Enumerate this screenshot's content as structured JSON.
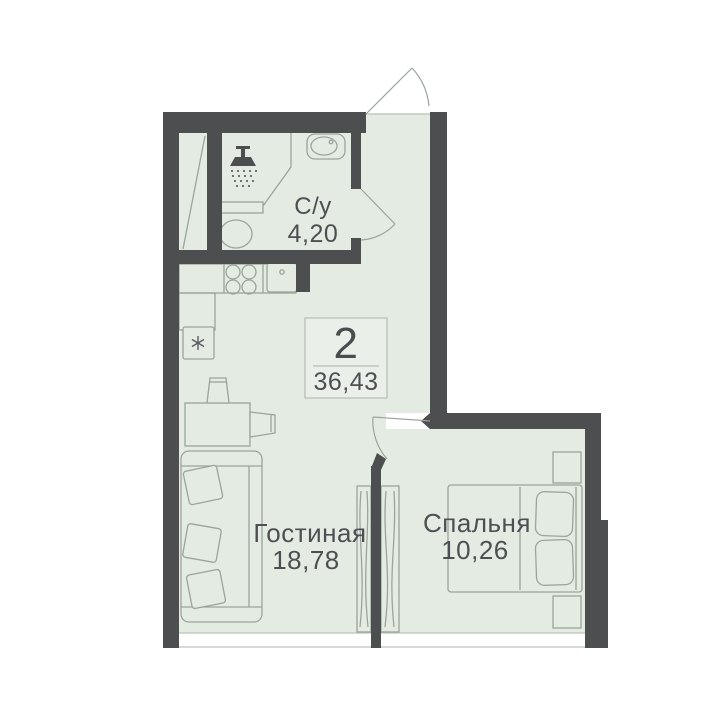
{
  "plan": {
    "summary": {
      "rooms_count": "2",
      "total_area": "36,43"
    },
    "rooms": [
      {
        "name": "bathroom",
        "label": "С/у",
        "area": "4,20"
      },
      {
        "name": "living-room",
        "label": "Гостиная",
        "area": "18,78"
      },
      {
        "name": "bedroom",
        "label": "Спальня",
        "area": "10,26"
      }
    ],
    "colors": {
      "wall": "#4d4e50",
      "floor": "#e4ebe3",
      "furniture_line": "#9ba49b",
      "thin_line": "#bcc3bb",
      "text": "#4e4f53",
      "background": "#ffffff"
    },
    "icons": {
      "shower": "shower-head-icon",
      "fridge": "snowflake-icon",
      "stove": "four-burner-stove-icon",
      "doors": "door-swing-arc"
    }
  }
}
